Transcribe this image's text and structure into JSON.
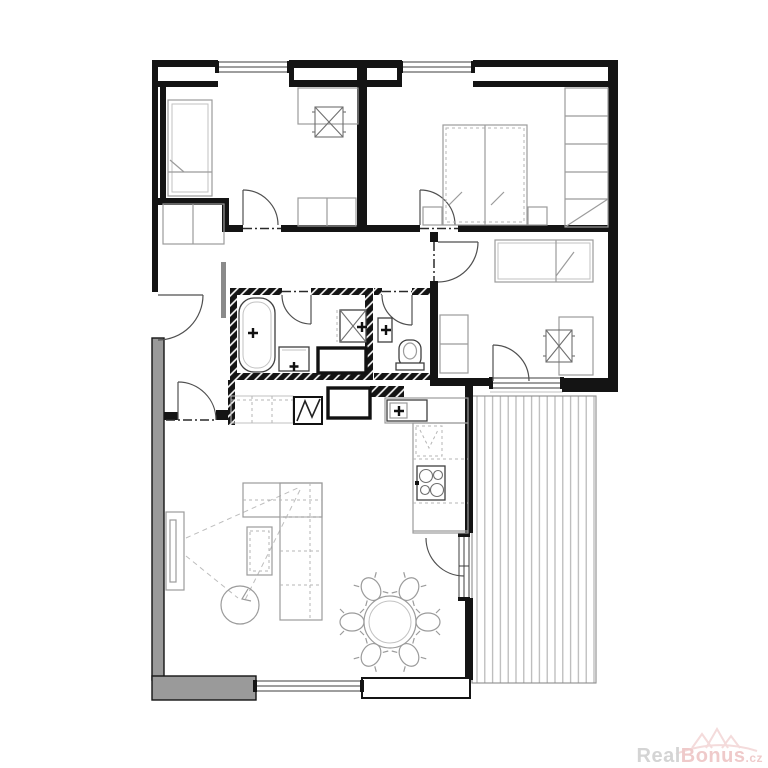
{
  "watermark": {
    "brand_prefix": "Real",
    "brand_suffix": "Bonus",
    "tld": ".cz"
  },
  "colors": {
    "wall": "#141414",
    "wall-gray": "#9a9a9a",
    "furn": "#9b9b9b",
    "deck-stripe": "#b5b5b5",
    "wm-gray": "#c6c6c6",
    "wm-pink": "#eab9b9",
    "background": "#ffffff"
  },
  "floorplan": {
    "type": "apartment-floor-plan",
    "rooms": [
      {
        "id": "bedroom-top-left",
        "fixtures": [
          "single-bed",
          "desk",
          "office-chair",
          "dresser"
        ]
      },
      {
        "id": "bedroom-master-top-right",
        "fixtures": [
          "double-bed",
          "nightstand-left",
          "nightstand-right",
          "wardrobe"
        ]
      },
      {
        "id": "bedroom-right",
        "fixtures": [
          "single-bed",
          "desk",
          "office-chair",
          "dresser"
        ]
      },
      {
        "id": "bathroom",
        "fixtures": [
          "bathtub",
          "washbasin",
          "washing-machine",
          "service-shaft"
        ]
      },
      {
        "id": "wc",
        "fixtures": [
          "toilet",
          "washbasin"
        ]
      },
      {
        "id": "hallway",
        "fixtures": [
          "cabinet",
          "built-in-wardrobe",
          "utility-box",
          "service-shaft",
          "partition-stub"
        ]
      },
      {
        "id": "living-room-with-kitchen",
        "fixtures": [
          "tv-unit",
          "corner-sofa",
          "coffee-table",
          "round-side-table",
          "dining-table",
          "dining-chairs-x6",
          "kitchen-counter",
          "kitchen-sink",
          "fridge",
          "cooktop"
        ]
      },
      {
        "id": "terrace",
        "fixtures": [
          "wood-decking"
        ]
      }
    ],
    "openings": {
      "windows": 4,
      "french_doors": 2,
      "interior_doors": 6,
      "entrance_doors": 1
    }
  }
}
